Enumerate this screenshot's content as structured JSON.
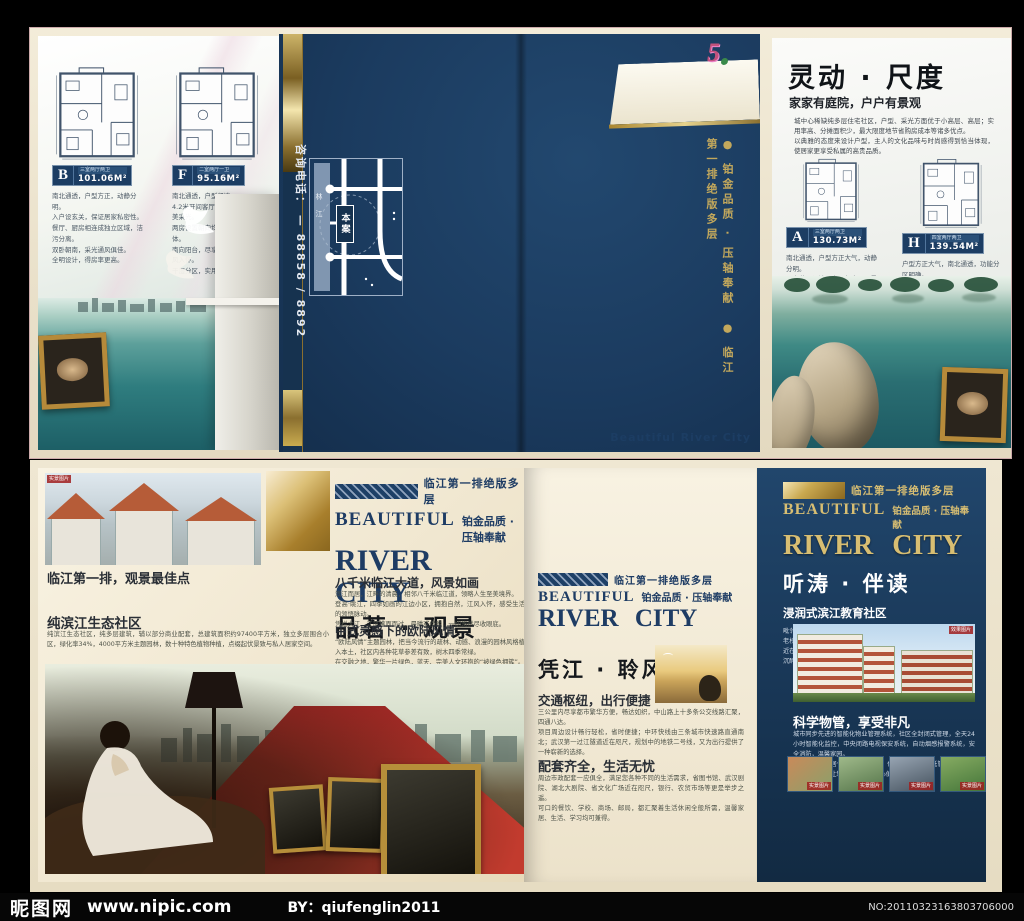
{
  "footer": {
    "logo": "昵图网",
    "url": "www.nipic.com",
    "by": "BY：qiufenglin2011",
    "serial": "NO:20110323163803706000"
  },
  "top": {
    "left": {
      "plans": [
        {
          "badge": "B",
          "spec": "三室两厅两卫",
          "area": "101.06M²",
          "desc": "南北通透，户型方正，动静分明。\n入户设玄关，保证居家私密性。\n餐厅、厨房相连成独立区域，洁污分离。\n双卧朝南，采光通风俱佳。\n全明设计，得房率更高。"
        },
        {
          "badge": "F",
          "spec": "二室两厅一卫",
          "area": "95.16M²",
          "desc": "南北通透，户型紧凑。\n4.2米开间客厅配观景飘窗，完美采光。\n两房设置朝向均好，餐厨相连得体。\n南向阳台，尽享园林景观，揽江风入怀。\n干湿分区，实用舒适。"
        }
      ]
    },
    "cover": {
      "phone": "咨询电话： — 88858 / 8892",
      "map_site": "本案",
      "map_river": "林江",
      "spine": "● 铂金品质 · 压轴奉献　● 临江第一排绝版多层",
      "tab_logo": "5",
      "tab_title": "Beautiful  River City"
    },
    "right": {
      "title": "灵动 · 尺度",
      "subtitle": "家家有庭院，户户有景观",
      "intro": "城中心稀缺纯多层住宅社区，户型、采光方面优于小高层、高层；实用率高、分摊面积少，最大限度地节省购房成本等诸多优点。\n以典雅的态度来设计户型，主人的文化品味与时尚感得到恰当体现，使居家更享受私属的高贵品质。",
      "plans": [
        {
          "badge": "A",
          "spec": "三室两厅两卫",
          "area": "130.73M²",
          "desc": "南北通透，户型方正大气，动静分明。\n入户花园设计，客厅朝南，观景效果佳。\n餐厨相连成独立功能区，洁污分离。\n主卧朝南设独立卫生间，舒适度更高。"
        },
        {
          "badge": "H",
          "spec": "四室两厅两卫",
          "area": "139.54M²",
          "desc": "户型方正大气，南北通透，功能分区明确。\n四房设计朝向均好，全家各得其所。\n超大观景客厅，餐厨独立，洁污分离。\n主卧套房设计，尊享私属空间。"
        }
      ]
    }
  },
  "bottom": {
    "left": {
      "photo_caption": "实景图片",
      "tagline": "临江第一排绝版多层",
      "beautiful": "BEAUTIFUL",
      "quality": "铂金品质 · 压轴奉献",
      "river_city": "RIVER CITY",
      "section": "品茗 · 观景",
      "h1": "临江第一排，观景最佳点",
      "h2": "纯滨江生态社区",
      "p2": "纯滨江生态社区，纯多层建筑，辅以部分商业配套，总建筑面积约97400平方米，独立多层围合小区，绿化率34%，4000平方米主题园林，数十种特色植物种植，点缀起伏景致与私人居家空间。",
      "h3": "八千米临江大道，风景如画",
      "p3": "滨江而居，江畔的清晨，相邻八千米临江道，领略人生至美境界。\n登高·眺江，四季如画的江边小区，拥抱自然，江风入怀，感受生活的领悟脉动。\n凭栏大江，江风拂面而过，晨曦或傍晚，一切悠然尽收眼底。",
      "h4": "中式灵感下的欧陆风情",
      "p4": "“欧陆风情”主题园林，把当今流行的疏林、动感、浪漫的园林风格植入本土，社区内各种花草参差有致，树木四季常绿。\n在交融之地，繁华一片绿色，蓝天、完美人文环抱的“被绿色拥簇”。"
    },
    "middle": {
      "tagline": "临江第一排绝版多层",
      "beautiful": "BEAUTIFUL",
      "quality": "铂金品质 · 压轴奉献",
      "river_city": "RIVER CITY",
      "section": "凭江 · 聆风",
      "h1": "交通枢纽，出行便捷",
      "p1": "三公里内尽享都市繁华方便，畅达如织，中山路上十多条公交线路汇聚，四通八达。\n项目周边设计畅行轻松，省时便捷；中环快线由三条城市快速路直通南北；武汉第一过江隧道近在咫尺，规划中的地铁二号线，又为出行提供了一种崭新的选择。",
      "h2": "配套齐全，生活无忧",
      "p2": "周边市政配套一应俱全，满足您各种不同的生活需求，省图书馆、武汉剧院、湖北大剧院、省文化广场近在咫尺，银行、农贸市场等更是举步之遥。\n可口的餐饮、学校、商场、邮局，都汇聚着生活休闲全般所需，温馨家居、生活、学习均可兼得。"
    },
    "right": {
      "tagline": "临江第一排绝版多层",
      "beautiful": "BEAUTIFUL",
      "quality": "铂金品质 · 压轴奉献",
      "river_city": "RIVER CITY",
      "section": "听涛 · 伴读",
      "sub": "浸润式滨江教育社区",
      "edu_p": "毗邻众多名校，藏珑中学、文华中学、实验中学、传媒小学等百年老校环绕周边；省城名学府，毗邻政法大学、教育学院等各大高校近在咫尺。\n沉醉文澜翰林的学府气息，浸染出众子弟恒远的风礼。",
      "photo_caption": "效果图片",
      "mgmt_h": "科学物管，享受非凡",
      "mgmt_p": "城市同步先进的智能化物业管理系统，社区全封闭式管理，全天24小时智能化监控，中央闭路电视保安系统，自动烟感报警系统，安全消防，温馨家园。\n社区还提供家居保洁、代收信函、代订牛奶、物业托管等贴心一站式管家服务，让您的生活更加省心便利。",
      "thumbs": [
        {
          "caption": "实景图片"
        },
        {
          "caption": "实景图片"
        },
        {
          "caption": "实景图片"
        },
        {
          "caption": "实景图片"
        }
      ]
    }
  }
}
